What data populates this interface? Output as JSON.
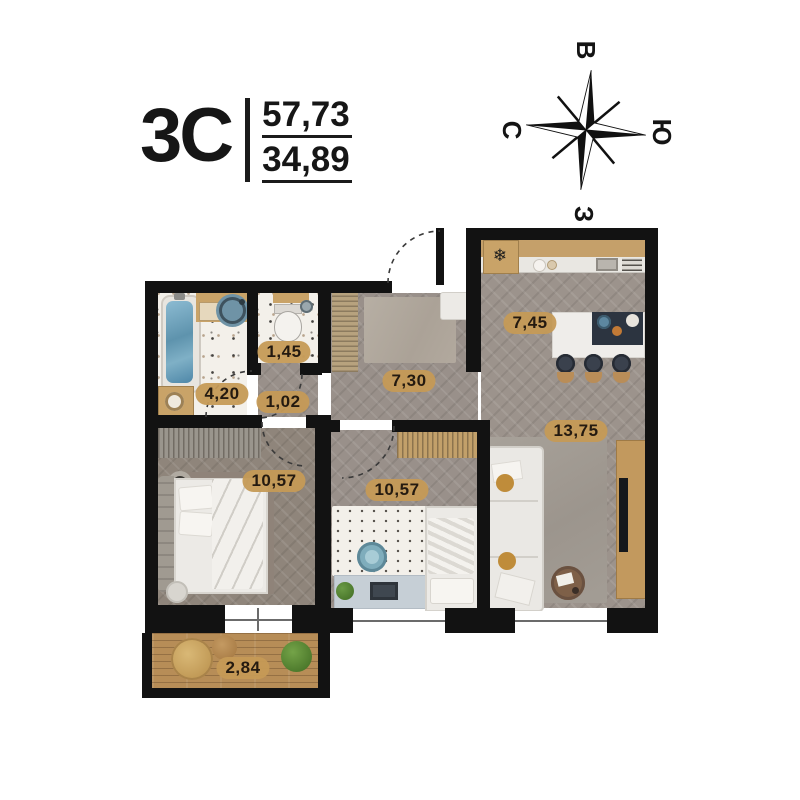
{
  "header": {
    "plan_code": "3С",
    "total_area": "57,73",
    "living_area": "34,89"
  },
  "compass": {
    "east": "В",
    "north": "С",
    "south": "Ю",
    "west": "З"
  },
  "rooms": {
    "bathroom": {
      "area": "4,20"
    },
    "wc": {
      "area": "1,45"
    },
    "hall_niche": {
      "area": "1,02"
    },
    "hallway": {
      "area": "7,30"
    },
    "kitchen": {
      "area": "7,45"
    },
    "living_room": {
      "area": "13,75"
    },
    "bedroom": {
      "area": "10,57"
    },
    "second_room": {
      "area": "10,57"
    },
    "balcony": {
      "area": "2,84"
    }
  },
  "icons": {
    "fridge": "❄"
  },
  "colors": {
    "wall": "#121212",
    "label_pill": "#c59a56",
    "label_text": "#241a10",
    "floor_wood": "#b78d57",
    "floor_stone": "#99908a",
    "water_blue": "#6f9fb5",
    "accent_mustard": "#bf8c3a"
  }
}
